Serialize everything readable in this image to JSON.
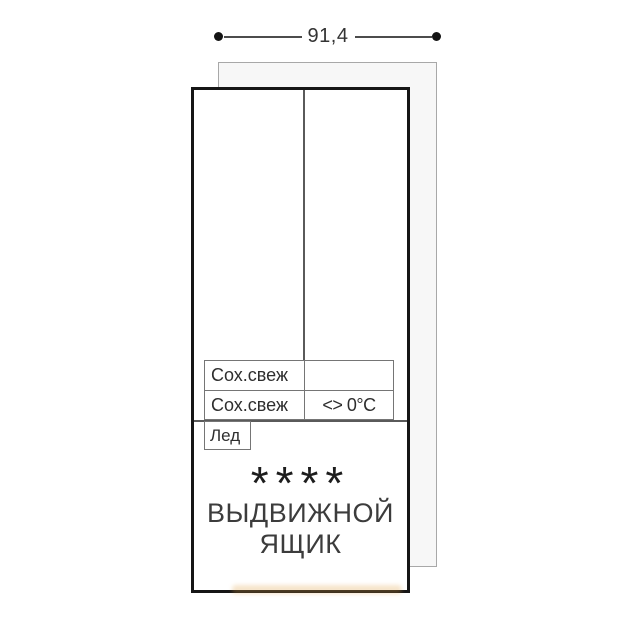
{
  "dimension": {
    "value": "91,4"
  },
  "compartments": {
    "zone_rows": [
      {
        "left": "Сох.свеж",
        "right": ""
      },
      {
        "left": "Сох.свеж",
        "right": "<> 0°C"
      }
    ],
    "ice_label": "Лед",
    "drawer": {
      "stars": "****",
      "title_line1": "ВЫДВИЖНОЙ",
      "title_line2": "ЯЩИК"
    }
  },
  "colors": {
    "outline": "#161616",
    "thin_line": "#757575",
    "divider": "#5a5a5a",
    "panel_fill": "#f7f7f7",
    "panel_border": "#a8a8a8",
    "text": "#2e2e2e",
    "watermark": "#e09e40"
  }
}
